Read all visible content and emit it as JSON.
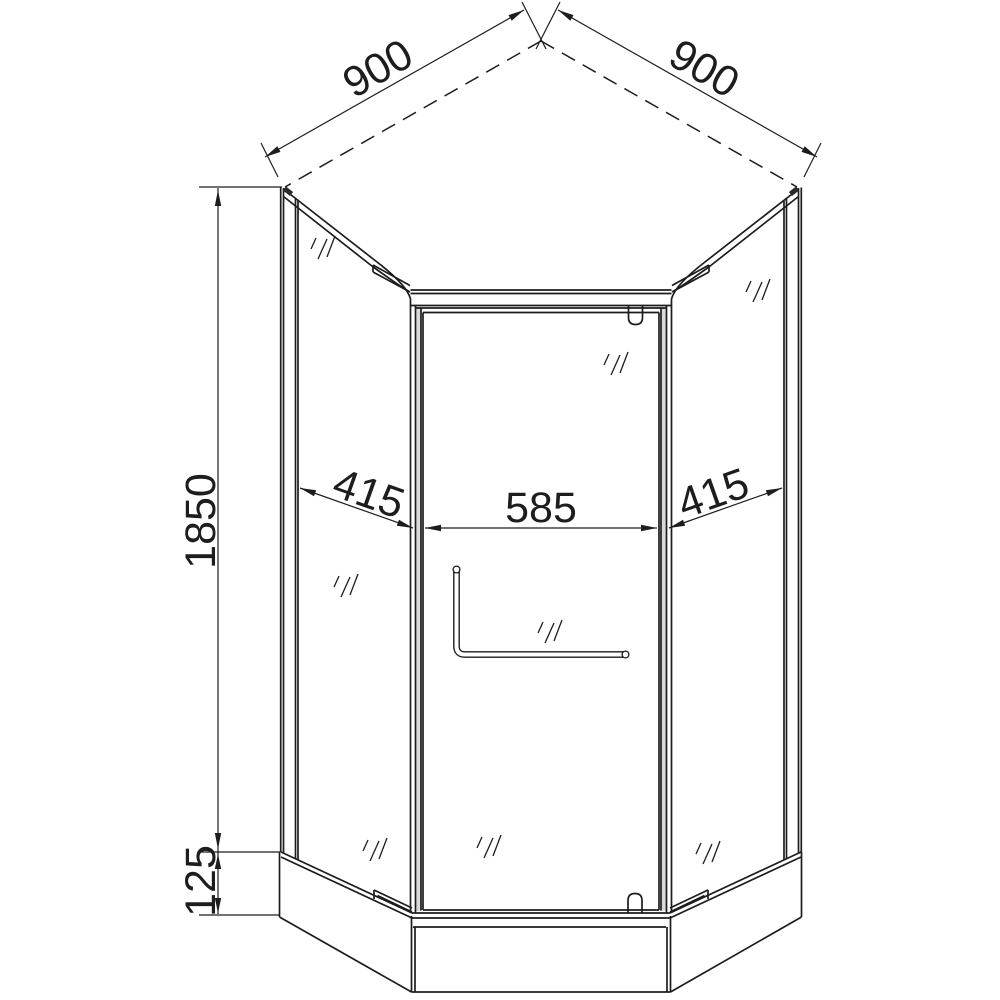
{
  "drawing": {
    "background_color": "#ffffff",
    "line_color": "#1d1d1d",
    "frame_shading_color": "#d9d9d9",
    "dimensions": {
      "top_left": "900",
      "top_right": "900",
      "height": "1850",
      "tray_height": "125",
      "left_panel": "415",
      "door_opening": "585",
      "right_panel": "415"
    }
  }
}
